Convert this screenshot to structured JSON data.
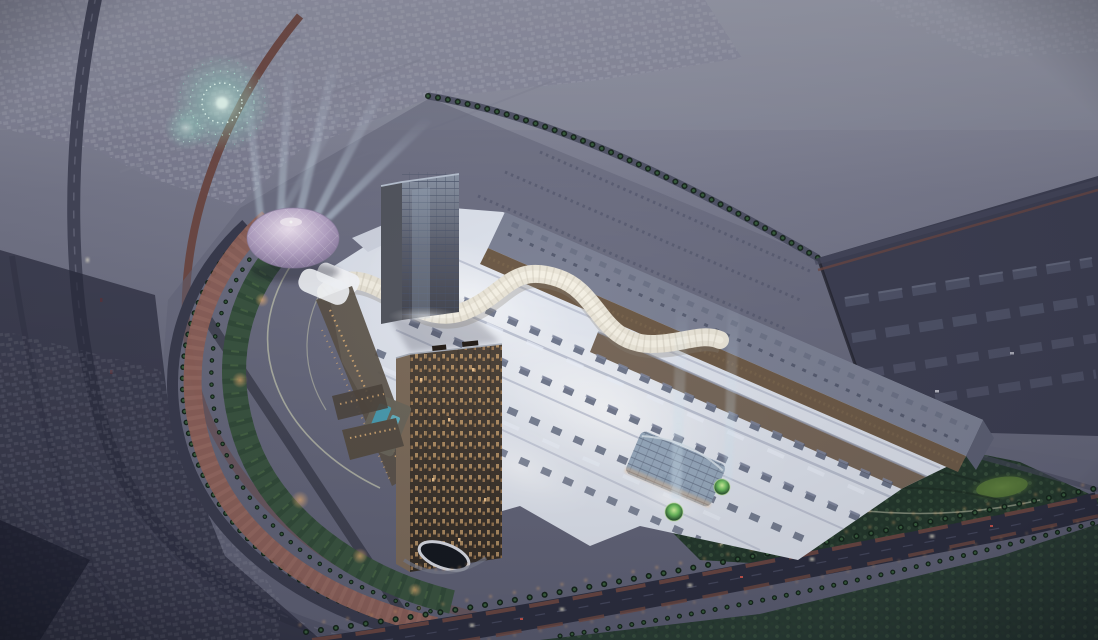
{
  "scene": {
    "setting": "aerial dusk architectural rendering of a large mall development",
    "landmarks": [
      "fireworks-burst",
      "spotlight-beams",
      "geodesic-dome",
      "glass-tower",
      "residential-tower",
      "mall-roof",
      "serpentine-atrium",
      "entrance-canopy",
      "crescent-park",
      "palm-boulevard",
      "warehouse-district",
      "illuminated-gardens"
    ]
  },
  "palette": {
    "sky-top": "#9a9cab",
    "sky-mid": "#7b7d90",
    "ground": "#6b6d80",
    "ground-low": "#585a6e",
    "shadow-zone": "#3c3e50",
    "deep-shadow": "#262839",
    "plot-ground": "#63657a",
    "suburb-house": "#a8aab8",
    "suburb-road": "#848698",
    "industrial": "#3d3f52",
    "warehouse": "#51556a",
    "green-dark": "#24382c",
    "green-mid": "#3a5440",
    "green-path": "#c8cab2",
    "lawn-bright": "#587a38",
    "palm-dark": "#14241a",
    "palm-light": "#3f6a44",
    "road-dark": "#2b2d3e",
    "road-mid": "#46485c",
    "track-red": "#6f4841",
    "promenade": "#8e6159",
    "mall-roof": "#dde2ec",
    "mall-bright": "#f5f7fb",
    "band-gap": "#b2b8ca",
    "rooftop-unit": "#545d74",
    "skylight": "#edf2fc",
    "atrium": "#eae5d8",
    "dark-hall": "#7d8295",
    "bronze": "#6e5b48",
    "dome-mid": "#b7a5c7",
    "glass-grid": "#49536a",
    "tower-side": "#7c6b5a",
    "window-warm": "#d9ad76",
    "pool-blue": "#4a9cb0",
    "canopy-glass": "#93a7ba",
    "street-glow": "#f0b474",
    "headlight": "#f8f3da",
    "taillight": "#c4524a"
  }
}
